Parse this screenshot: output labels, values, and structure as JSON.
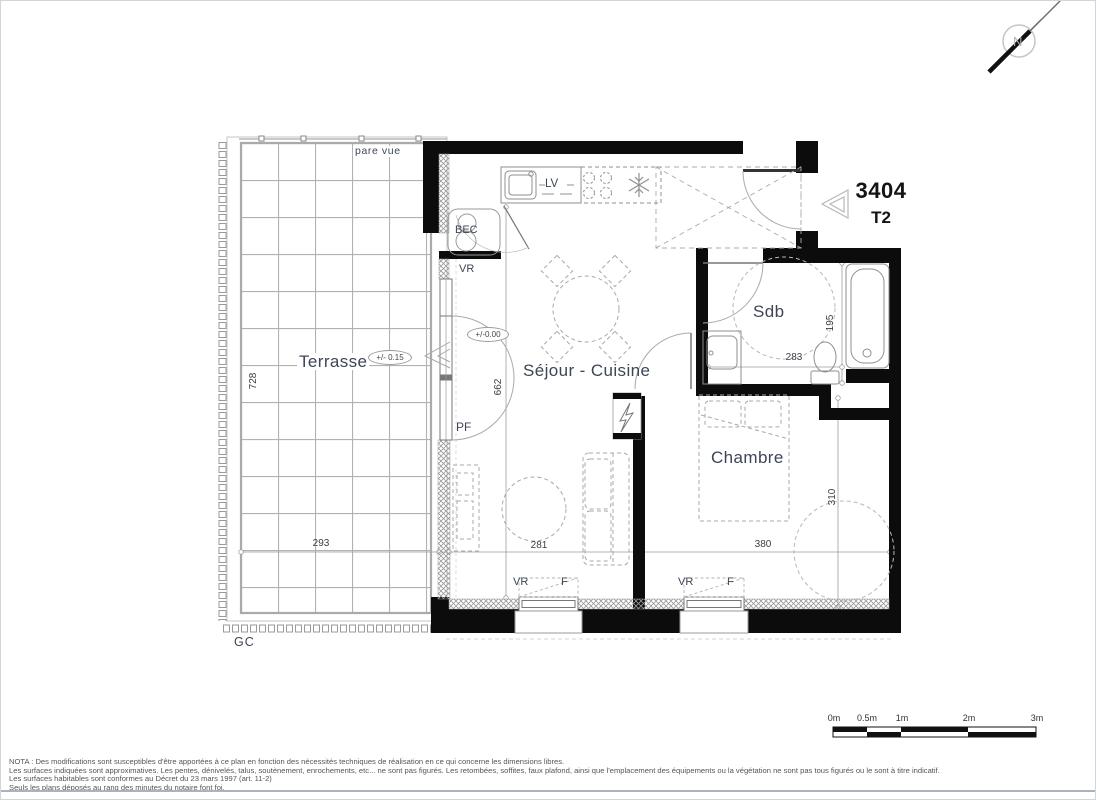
{
  "unit": {
    "number": "3404",
    "type": "T2"
  },
  "north_label": "N",
  "rooms": {
    "terrasse": {
      "name": "Terrasse",
      "level": "+/- 0.15",
      "width": "293",
      "height": "728"
    },
    "sejour": {
      "name": "Séjour - Cuisine",
      "level": "+/-0.00",
      "width": "281",
      "height": "662"
    },
    "chambre": {
      "name": "Chambre",
      "width": "380",
      "height": "310"
    },
    "sdb": {
      "name": "Sdb",
      "width": "283",
      "height": "195"
    }
  },
  "labels": {
    "pare_vue": "pare vue",
    "gc": "GC",
    "bec": "BEC",
    "lv": "LV",
    "pf": "PF",
    "vr": "VR",
    "f": "F"
  },
  "scale_bar": {
    "labels": [
      "0m",
      "0.5m",
      "1m",
      "2m",
      "3m"
    ]
  },
  "nota": [
    "NOTA : Des modifications sont susceptibles d'être apportées à ce plan en fonction des nécessités techniques de réalisation en ce qui concerne les dimensions libres.",
    "Les surfaces indiquées sont approximatives. Les pentes, dénivelés, talus, soutènement, enrochements, etc... ne sont pas figurés. Les retombées, soffites, faux plafond, ainsi que l'emplacement des équipements ou la végétation ne sont pas tous figurés ou le sont à titre indicatif.",
    "Les surfaces habitables sont conformes au Décret du 23 mars 1997 (art. 11-2)",
    "Seuls les plans déposés au rang des minutes du notaire font foi."
  ],
  "colors": {
    "wall": "#0c0c0c",
    "label": "#3c4654",
    "line": "#9a9a9a"
  }
}
